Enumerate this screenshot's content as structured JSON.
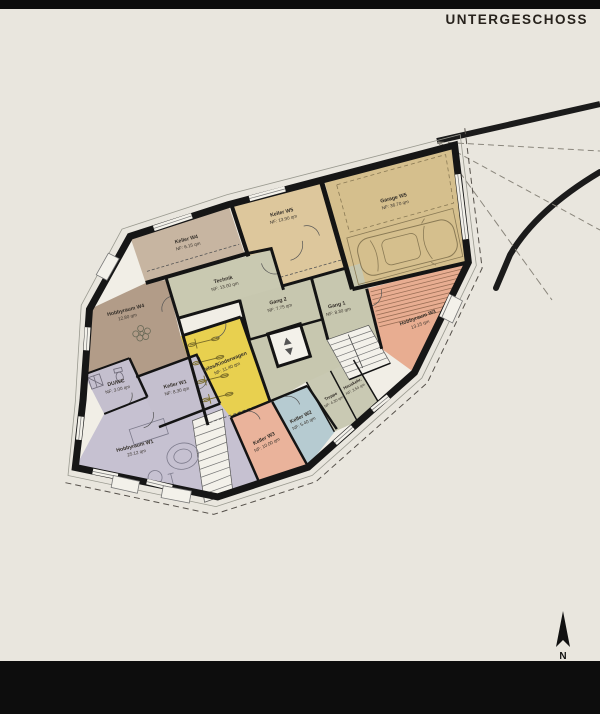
{
  "header": {
    "title": "UNTERGESCHOSS"
  },
  "compass": {
    "label": "N"
  },
  "colors": {
    "background": "#e9e6de",
    "bar": "#0d0d0d",
    "wall": "#161616",
    "plan_floor": "#f1eee6",
    "site_line": "#1b1b1b",
    "stair_fill": "#f3f1ea",
    "detail_stroke": "#8a7a55"
  },
  "rooms": [
    {
      "id": "keller-w4",
      "name": "Keller W4",
      "area": "NF: 6.15 qm",
      "color": "#c7b5a1"
    },
    {
      "id": "keller-w5",
      "name": "Keller W5",
      "area": "NF: 13.90 qm",
      "color": "#ddc79c"
    },
    {
      "id": "garage-w5",
      "name": "Garage W5",
      "area": "NF: 36.70 qm",
      "color": "#d5bf8d"
    },
    {
      "id": "technik",
      "name": "Technik",
      "area": "NF: 13.00 qm",
      "color": "#c9c9b1"
    },
    {
      "id": "gang-2",
      "name": "Gang 2",
      "area": "NF: 7.75 qm",
      "color": "#c7c7af"
    },
    {
      "id": "gang-1",
      "name": "Gang 1",
      "area": "NF: 8.30 qm",
      "color": "#c7c7af"
    },
    {
      "id": "hobbyraum-w4",
      "name": "Hobbyraum W4",
      "area": "12.80 qm",
      "color": "#b29c88"
    },
    {
      "id": "velos-kinderwagen",
      "name": "Velos/Kinderwagen",
      "area": "NF: 11.40 qm",
      "color": "#e8d04f"
    },
    {
      "id": "hobbyraum-w3",
      "name": "Hobbyraum W3",
      "area": "13.15 qm",
      "color": "#e8ad91"
    },
    {
      "id": "treppe",
      "name": "Treppe",
      "area": "NF: 4.30 qm",
      "color": "#c9c9b3"
    },
    {
      "id": "hauskehr",
      "name": "Hauskehr.",
      "area": "NF: 3.54 qm",
      "color": "#c9c9b3"
    },
    {
      "id": "keller-w2",
      "name": "Keller W2",
      "area": "NF: 5.40 qm",
      "color": "#b6cbd1"
    },
    {
      "id": "keller-w3",
      "name": "Keller W3",
      "area": "NF: 10.00 qm",
      "color": "#eab39b"
    },
    {
      "id": "keller-w1",
      "name": "Keller W1",
      "area": "NF: 8.30 qm",
      "color": "#c4bfce"
    },
    {
      "id": "du-wc",
      "name": "DU/WC",
      "area": "NF: 3.00 qm",
      "color": "#c4bfce"
    },
    {
      "id": "hobbyraum-w1",
      "name": "Hobbyraum W1",
      "area": "25.12 qm",
      "color": "#c6c1d1"
    }
  ]
}
